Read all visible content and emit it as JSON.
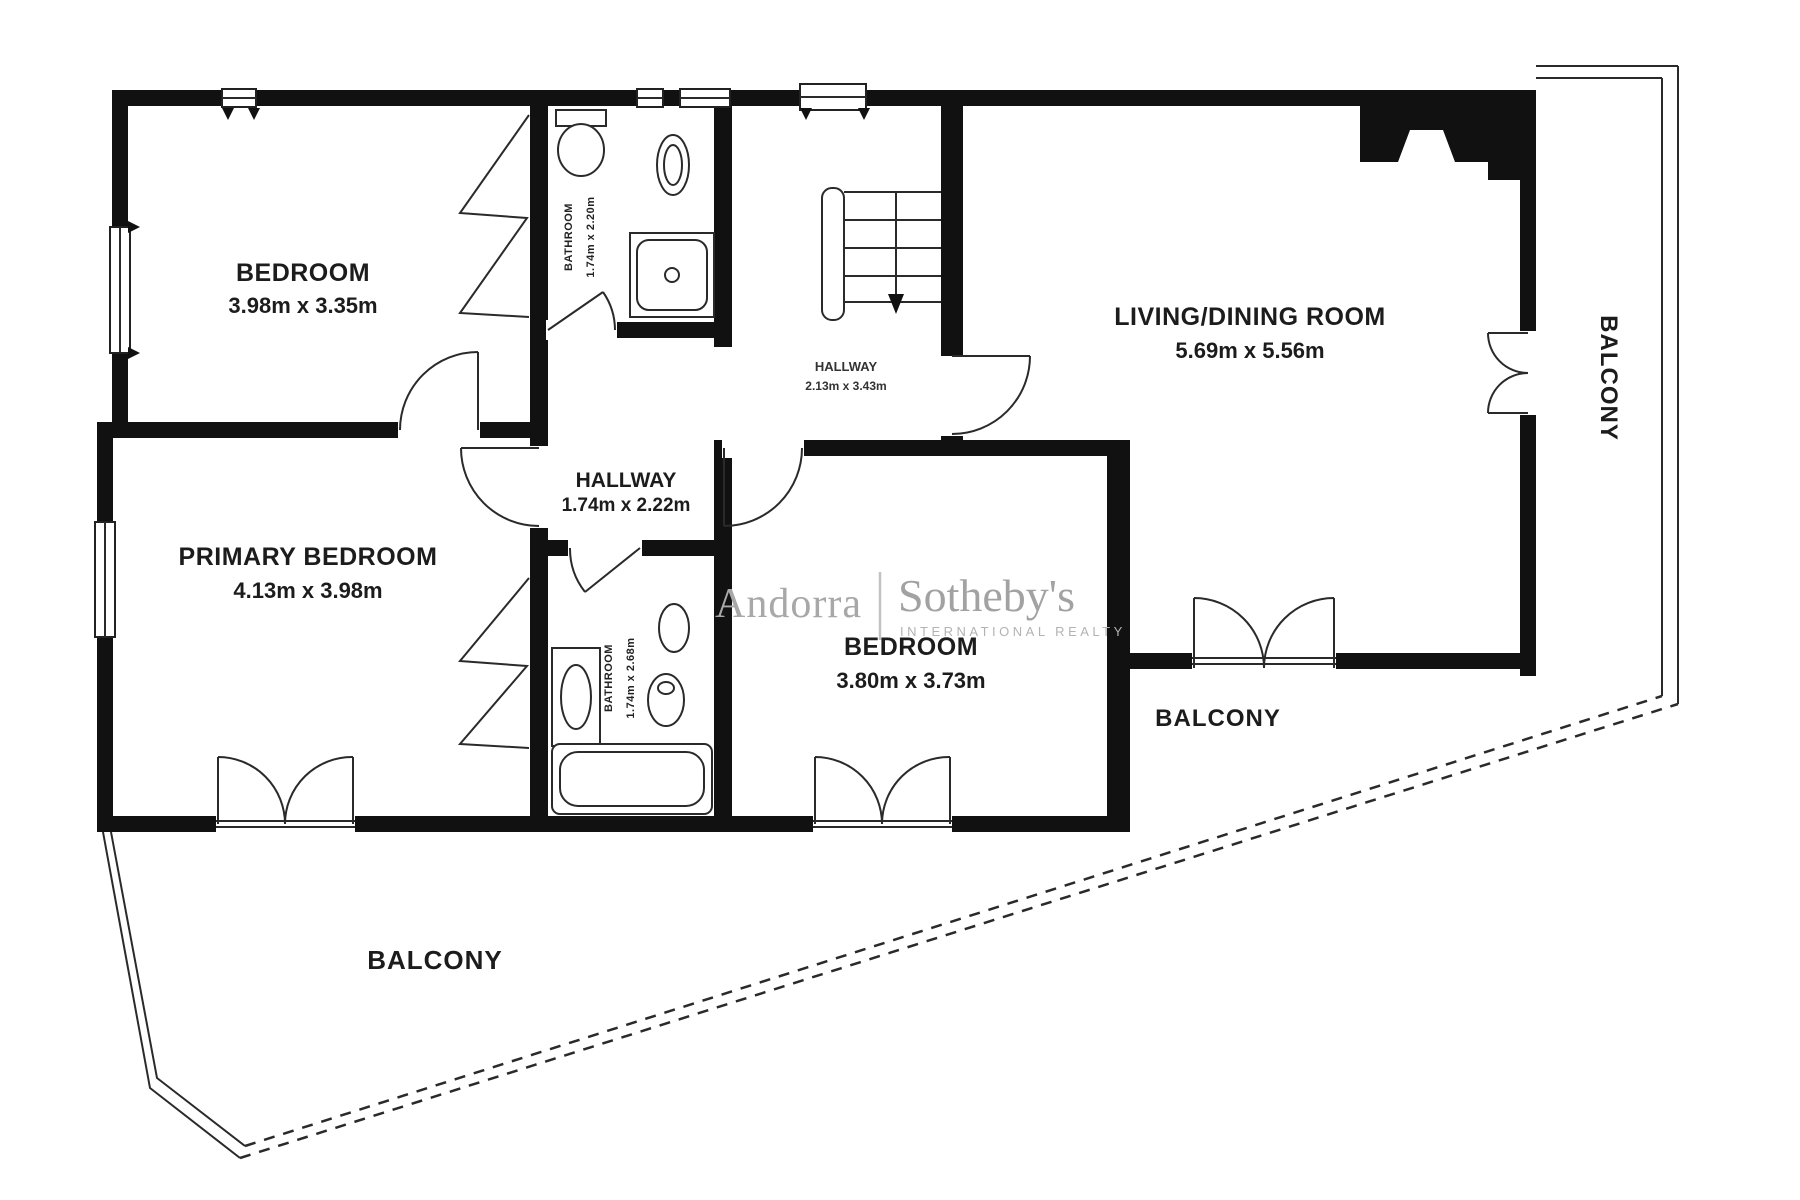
{
  "plan": {
    "rooms": [
      {
        "name": "BEDROOM",
        "dims": "3.98m x 3.35m"
      },
      {
        "name": "PRIMARY BEDROOM",
        "dims": "4.13m x 3.98m"
      },
      {
        "name": "LIVING/DINING ROOM",
        "dims": "5.69m x 5.56m"
      },
      {
        "name": "BEDROOM",
        "dims": "3.80m x 3.73m"
      },
      {
        "name": "HALLWAY",
        "dims": "1.74m x 2.22m"
      },
      {
        "name": "HALLWAY",
        "dims": "2.13m x 3.43m"
      },
      {
        "name": "BATHROOM",
        "dims": "1.74m x 2.20m"
      },
      {
        "name": "BATHROOM",
        "dims": "1.74m x 2.68m"
      }
    ],
    "balcony_labels": [
      "BALCONY",
      "BALCONY",
      "BALCONY"
    ],
    "watermark": {
      "brand_left": "Andorra",
      "brand_right": "Sotheby's",
      "tagline": "INTERNATIONAL REALTY"
    },
    "colors": {
      "wall": "#111111",
      "line": "#2a2a2a",
      "label_text": "#1c1c1c",
      "watermark_gray": "#a8a8a8"
    }
  }
}
